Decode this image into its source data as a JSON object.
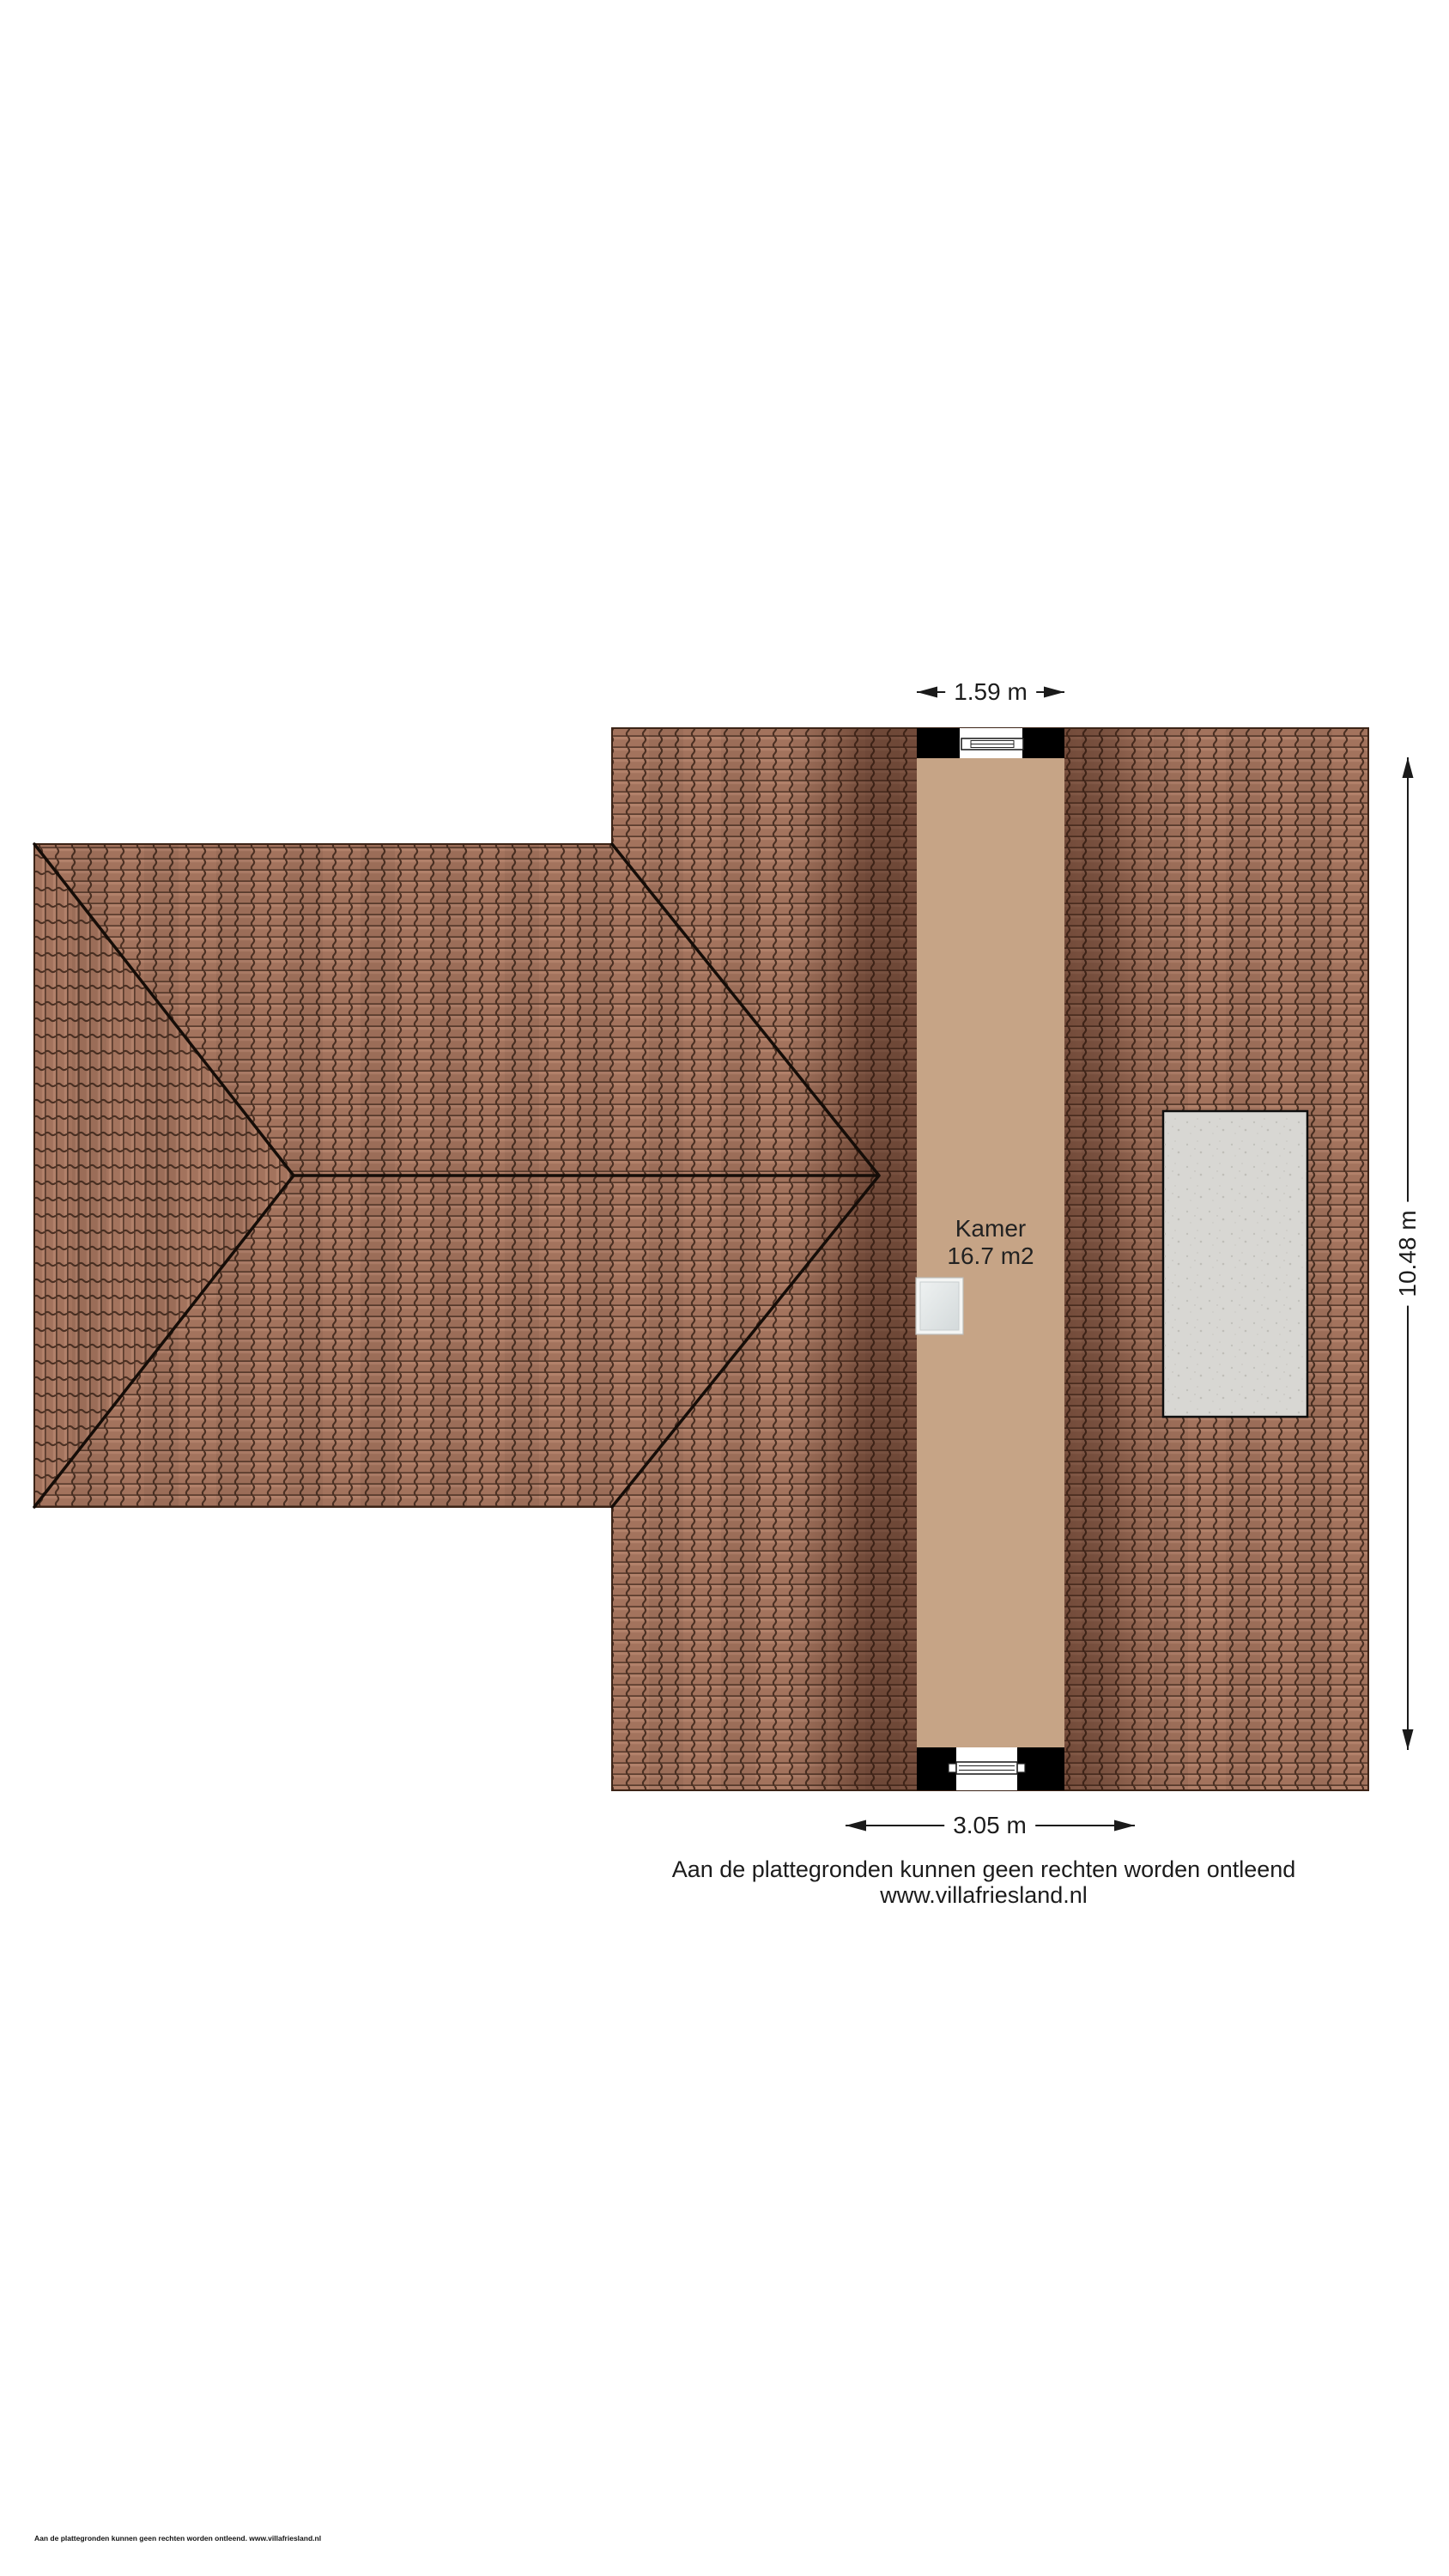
{
  "plan": {
    "type": "roof-floorplan",
    "room": {
      "name": "Kamer",
      "area": "16.7 m2"
    },
    "dimensions": {
      "top_width": "1.59 m",
      "bottom_width": "3.05 m",
      "right_height": "10.48 m"
    },
    "footer": {
      "line1": "Aan de plattegronden kunnen geen rechten worden ontleend",
      "line2": "www.villafriesland.nl"
    },
    "fine_print": "Aan de plattegronden kunnen geen rechten worden ontleend. www.villafriesland.nl",
    "colors": {
      "roof_tile": "#a3735d",
      "tile_joint": "#5a3c2d",
      "roof_shadow": "#2e1208",
      "room_fill": "#c6a486",
      "wall_black": "#000000",
      "concrete_panel": "#d8d7d3",
      "line_black": "#1a1a1a",
      "glass": "#dde4e5"
    }
  }
}
